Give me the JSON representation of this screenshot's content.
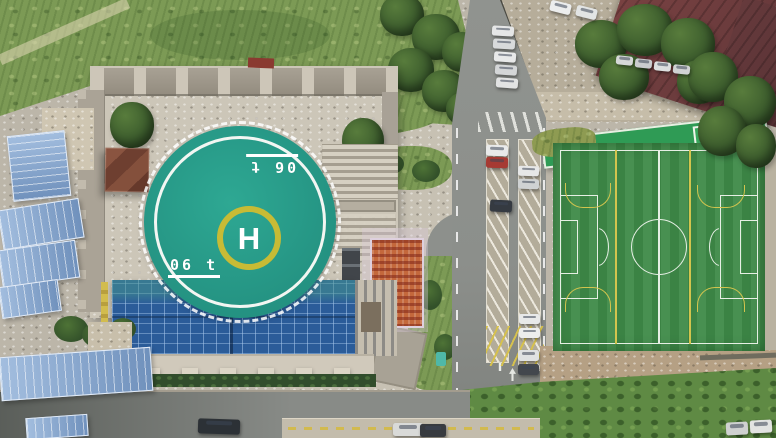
{
  "scene": {
    "type": "aerial-drone-photo",
    "description": "Top-down aerial photo of a rooftop helipad on a castle-style building with a blue glass atrium, construction sheds with blue roofs to the west, a road with angled parking, a green artificial-turf soccer field to the east, gravel car park and maroon-roofed building to the north-east"
  },
  "helipad": {
    "letter": "H",
    "weight_marking": "06 t"
  },
  "colors": {
    "helipad_surface": "#28a28c",
    "helipad_ring": "#ffffff",
    "h_circle_yellow": "#c7bb35",
    "glass_roof_blue": "#2b5c99",
    "soccer_turf_green": "#3e8a48",
    "field_line_white": "#e6efe4",
    "field_line_yellow": "#d2c44e",
    "shed_roof_blue": "#84a8d4",
    "maroon_roof": "#6d393b",
    "asphalt_gray": "#8e918d",
    "grass_green": "#7c9a55",
    "concrete": "#c9c3b5",
    "dirt": "#b5a084",
    "red_car": "#a63a33"
  }
}
